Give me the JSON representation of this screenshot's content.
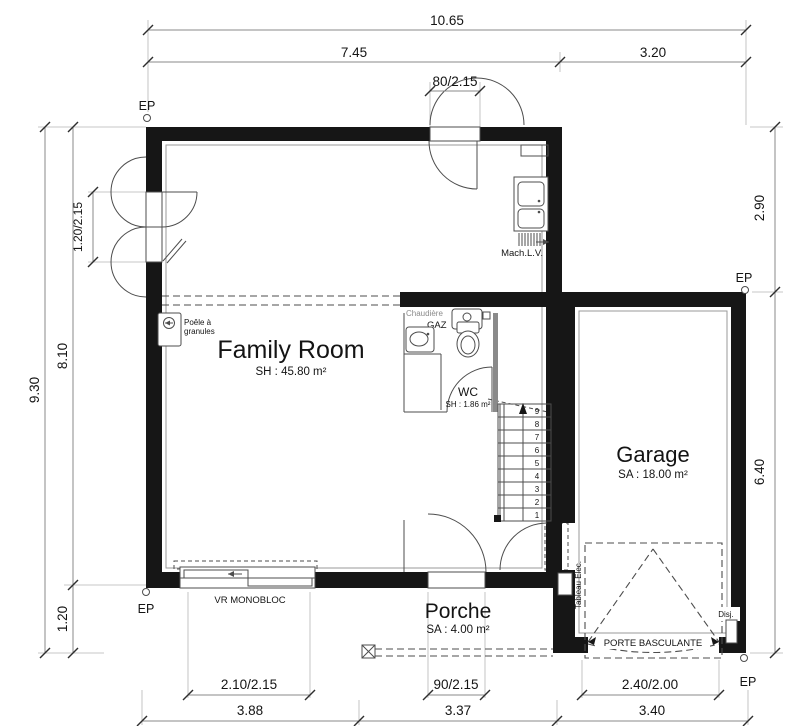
{
  "plan": {
    "type": "ground-floor-plan"
  },
  "rooms": {
    "family_room": {
      "name": "Family Room",
      "area": "SH : 45.80 m²"
    },
    "garage": {
      "name": "Garage",
      "area": "SA : 18.00 m²"
    },
    "wc": {
      "name": "WC",
      "area": "SH : 1.86 m²"
    },
    "porch": {
      "name": "Porche",
      "area": "SA : 4.00 m²"
    }
  },
  "dimensions": {
    "top_total": "10.65",
    "top_left": "7.45",
    "top_right": "3.20",
    "top_door": "80/2.15",
    "left_total": "9.30",
    "left_upper": "8.10",
    "left_lower": "1.20",
    "left_door": "1.20/2.15",
    "right_upper": "2.90",
    "right_lower": "6.40",
    "bottom_window": "2.10/2.15",
    "bottom_door": "90/2.15",
    "bottom_garage_door": "2.40/2.00",
    "bottom_seg_left": "3.88",
    "bottom_seg_mid": "3.37",
    "bottom_seg_right": "3.40"
  },
  "annotations": {
    "ep": "EP",
    "mach_lv": "Mach.L.V.",
    "poele_line1": "Poêle à",
    "poele_line2": "granules",
    "chaudiere": "Chaudière",
    "gaz": "GAZ",
    "vr_monobloc": "VR MONOBLOC",
    "tableau_elec": "Tableau Elec.",
    "porte_basculante": "PORTE BASCULANTE",
    "disj": "Disj."
  },
  "stairs": {
    "steps": [
      "1",
      "2",
      "3",
      "4",
      "5",
      "6",
      "7",
      "8",
      "9"
    ]
  },
  "colors": {
    "wall": "#161616",
    "line": "#4d4d4d",
    "dim_line": "#8a8a8a",
    "text": "#141414"
  }
}
